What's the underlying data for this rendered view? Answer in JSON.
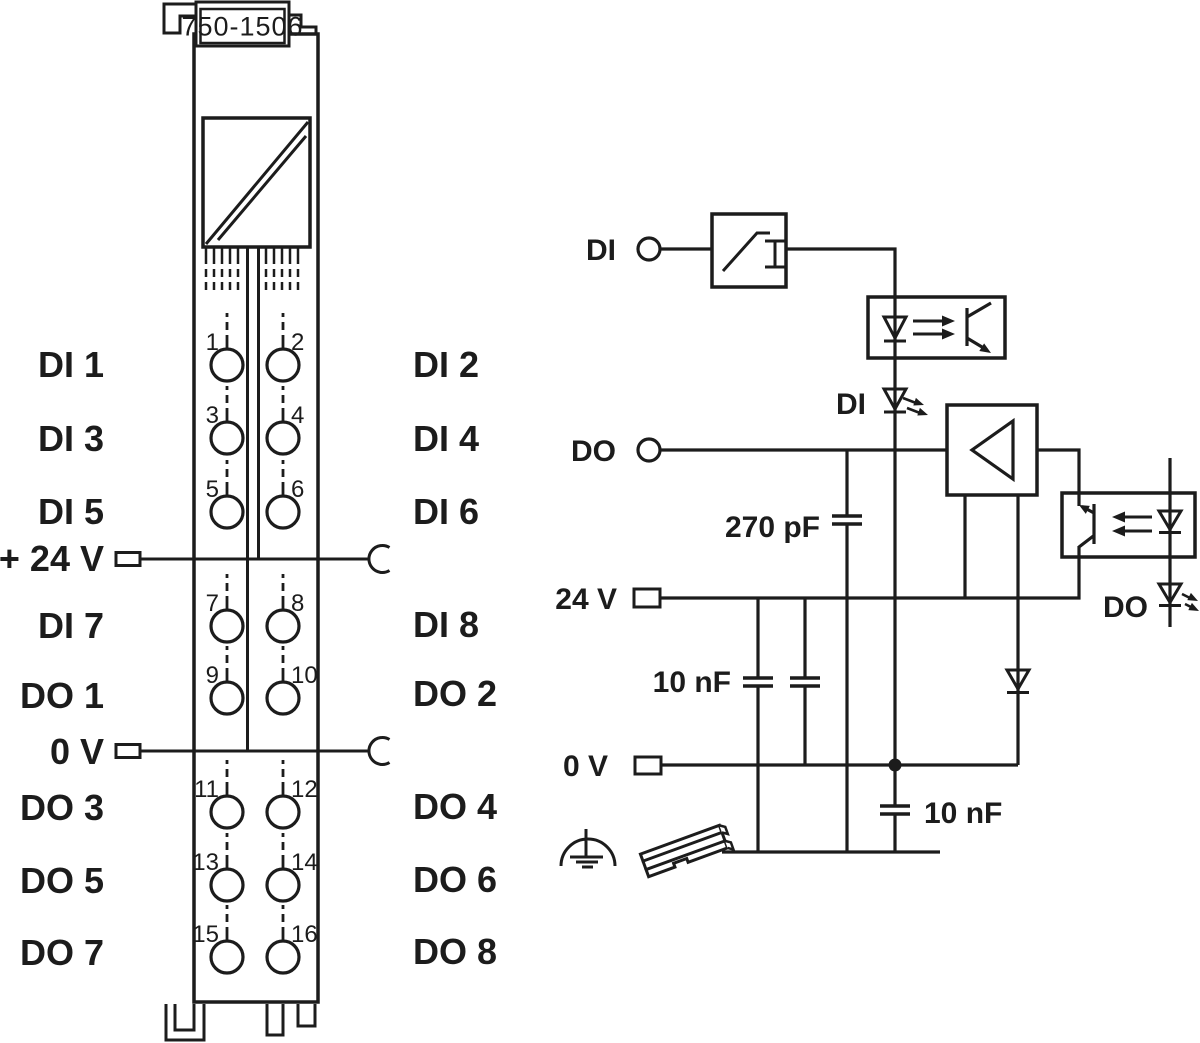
{
  "colors": {
    "line": "#1c1c1c",
    "background": "#ffffff"
  },
  "module": {
    "part_number": "750-1506",
    "left_labels": [
      "DI 1",
      "DI 3",
      "DI 5",
      "+ 24 V",
      "DI 7",
      "DO 1",
      "0 V",
      "DO 3",
      "DO 5",
      "DO 7"
    ],
    "right_labels": [
      "DI 2",
      "DI 4",
      "DI 6",
      "DI 8",
      "DO 2",
      "DO 4",
      "DO 6",
      "DO 8"
    ],
    "contact_numbers": [
      "1",
      "2",
      "3",
      "4",
      "5",
      "6",
      "7",
      "8",
      "9",
      "10",
      "11",
      "12",
      "13",
      "14",
      "15",
      "16"
    ]
  },
  "schematic": {
    "input_terminal_label": "DI",
    "output_terminal_label": "DO",
    "supply_terminal_label": "24 V",
    "ground_terminal_label": "0 V",
    "di_led_label": "DI",
    "do_led_label": "DO",
    "cap_270pf_label": "270 pF",
    "cap_10nf_label": "10 nF",
    "cap_10nf_bottom_label": "10 nF"
  }
}
